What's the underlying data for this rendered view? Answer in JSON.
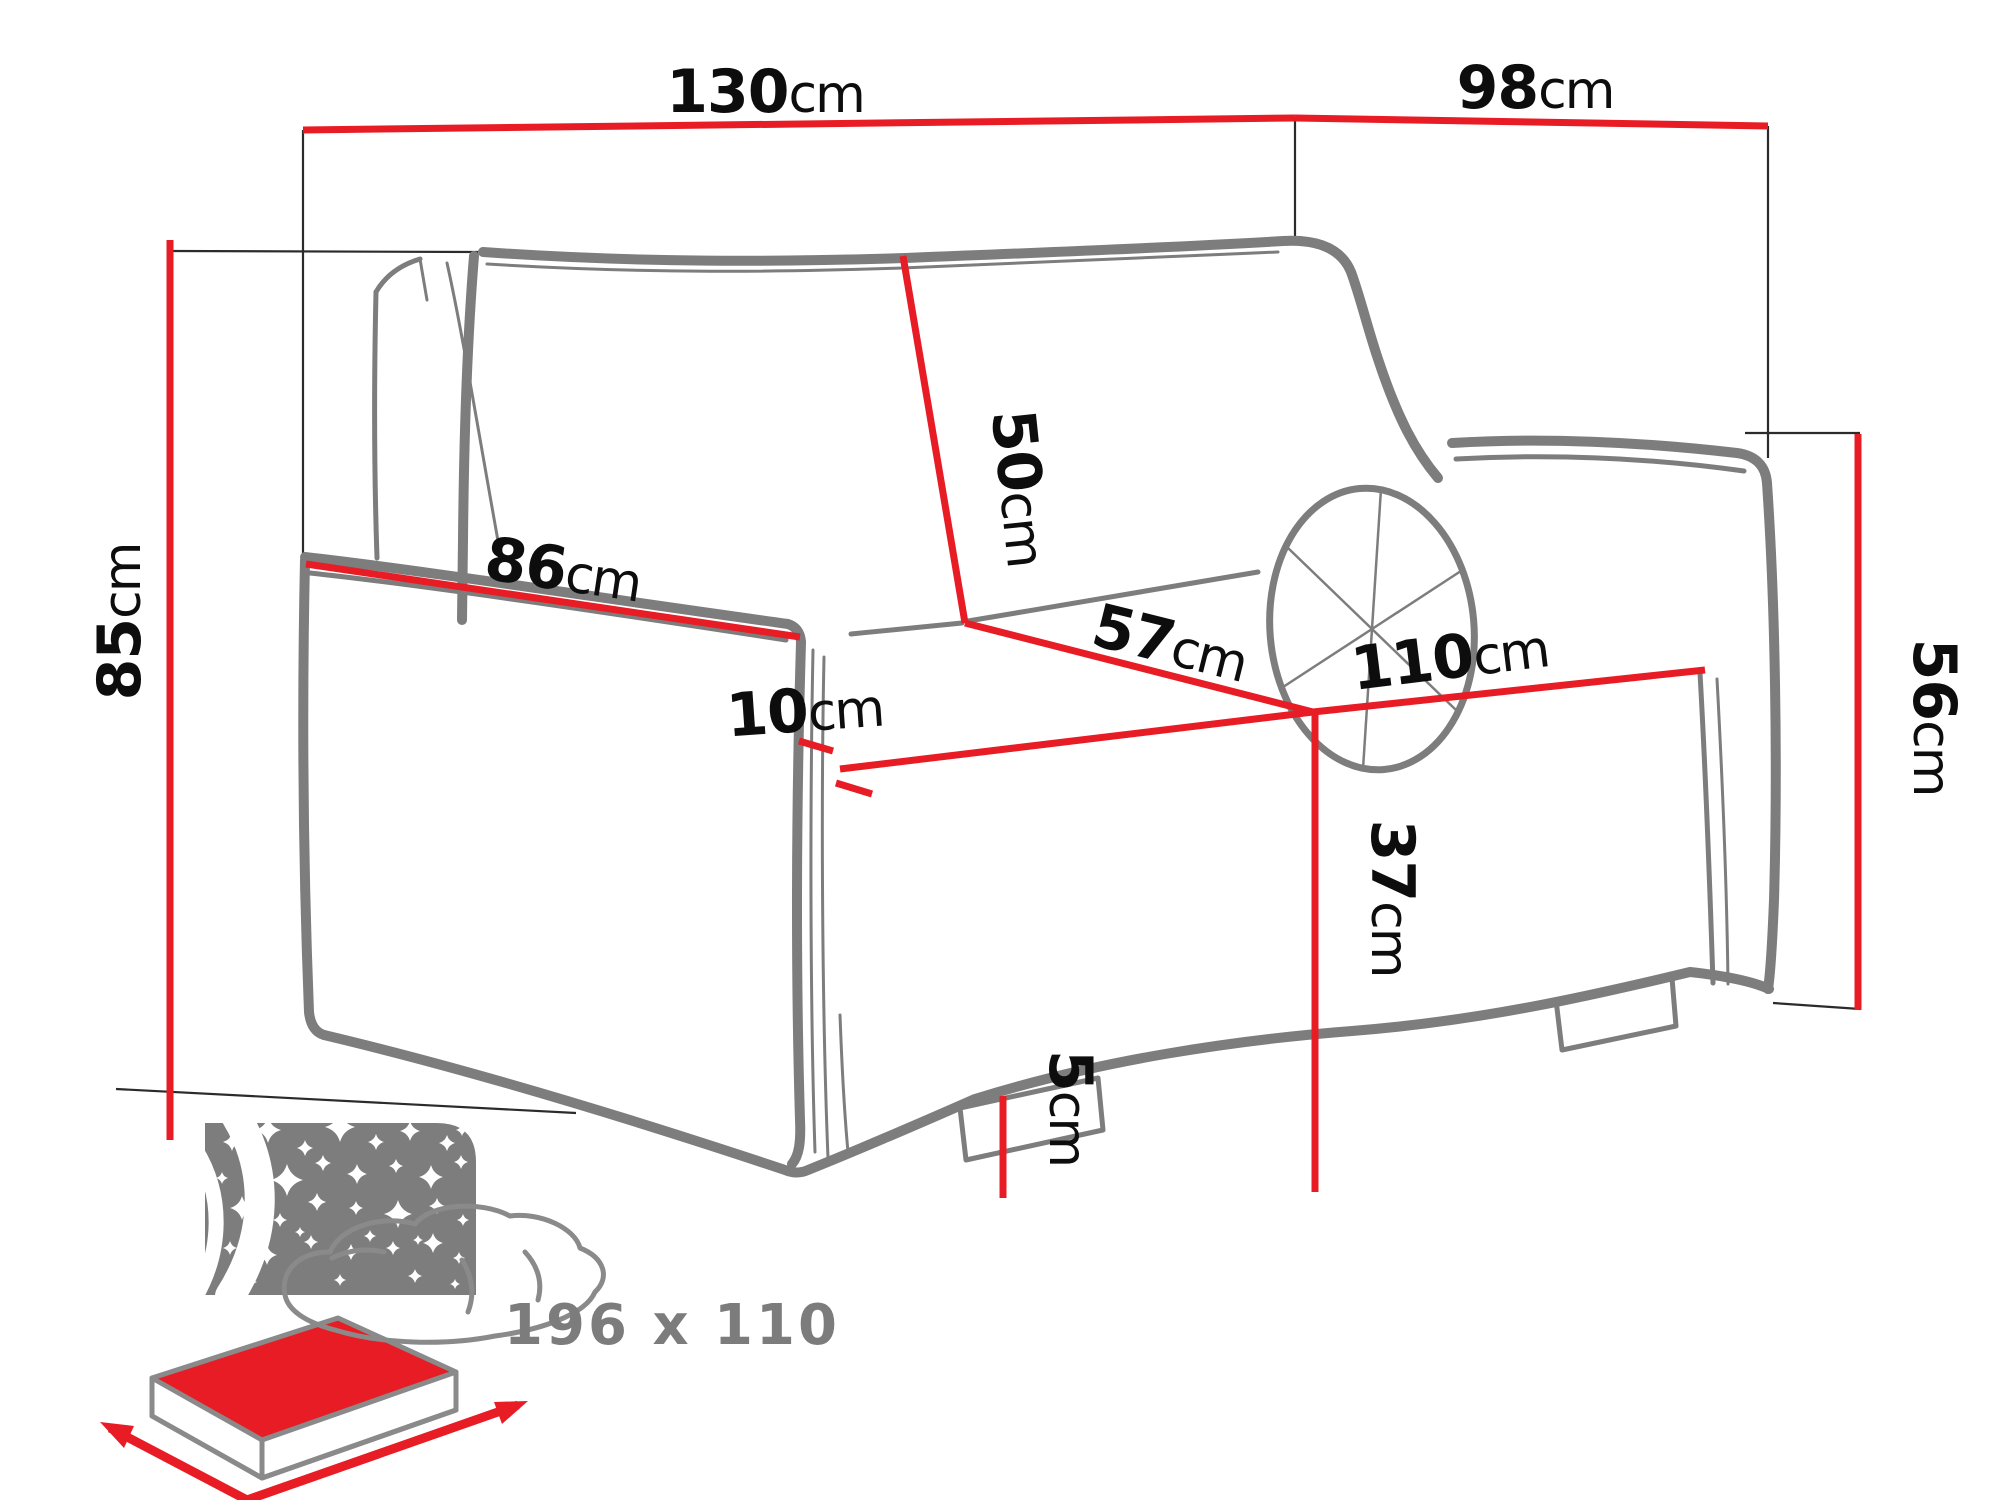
{
  "diagram": {
    "title": "sofa-bed-dimension-diagram",
    "unit": "cm",
    "dimensions": {
      "total_width": {
        "value": "130",
        "unit": "cm"
      },
      "total_depth": {
        "value": "98",
        "unit": "cm"
      },
      "total_height": {
        "value": "85",
        "unit": "cm"
      },
      "backrest_height": {
        "value": "50",
        "unit": "cm"
      },
      "armrest_length": {
        "value": "86",
        "unit": "cm"
      },
      "armrest_width": {
        "value": "10",
        "unit": "cm"
      },
      "seat_depth": {
        "value": "57",
        "unit": "cm"
      },
      "seat_width": {
        "value": "110",
        "unit": "cm"
      },
      "armrest_height": {
        "value": "56",
        "unit": "cm"
      },
      "seat_height": {
        "value": "37",
        "unit": "cm"
      },
      "leg_height": {
        "value": "5",
        "unit": "cm"
      }
    },
    "sleeping_area": {
      "label": "196 x 110"
    }
  },
  "colors": {
    "dimension_red": "#e81c24",
    "outline_gray": "#7d7d7d",
    "icon_gray": "#7d7d7d",
    "text_black": "#0d0d0d",
    "text_gray": "#7c7c7c",
    "extension_line": "#2b2b2b"
  }
}
